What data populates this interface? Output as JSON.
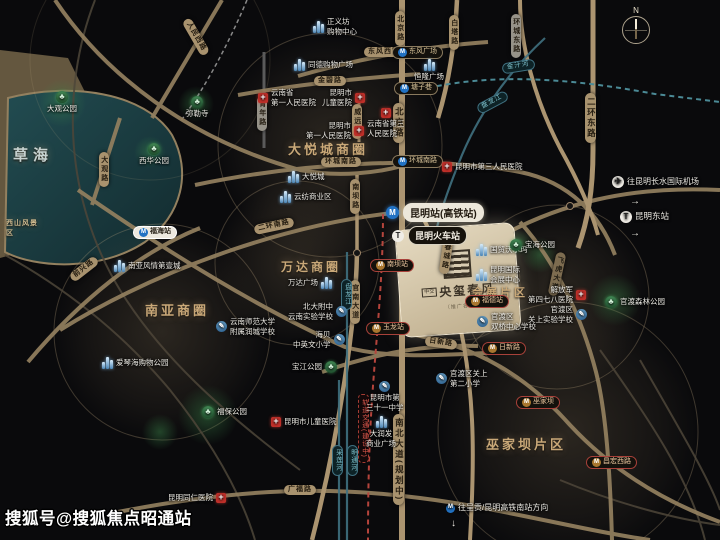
{
  "watermark": "搜狐号@搜狐焦点昭通站",
  "compass": {
    "north": "N"
  },
  "project": {
    "prefix": "中交",
    "name": "央玺春风",
    "note": "（推广名）"
  },
  "districts": {
    "caohai": "草海",
    "xishan": "西山风景区",
    "dayuecheng": "大悦城商圈",
    "wanda": "万达商圈",
    "nanya": "南亚商圈",
    "huizhan": "会展片区",
    "wujiaba": "巫家坝片区"
  },
  "roads": {
    "beijing": "北京路",
    "baita": "白塔路",
    "huancheng_dong": "环城东路",
    "erhuan_dong": "二环东路",
    "dongfeng_xi": "东风西路",
    "jinbi": "金碧路",
    "huancheng_nan": "环城南路",
    "erhuan_nan": "二环南路",
    "renmin_xi": "人民西路",
    "daguan": "大观路",
    "qianxing": "前兴路",
    "qingnian": "青年路",
    "weiyuan": "威远街",
    "nanba": "南坝路",
    "guannan": "官南大道",
    "chuncheng": "春城路",
    "feihu": "飞虎大道",
    "rixin": "日新路",
    "guangfu": "广福路",
    "nanbei_planned": "南北大道(规划中)",
    "metro_constr": "轨道交通(建设中)"
  },
  "rivers": {
    "panlong": "盘龙江",
    "jinzhi": "金汁河",
    "cailian": "采莲河",
    "mingtong": "明通河"
  },
  "stations": {
    "dongfeng_sq": "东风广场",
    "tangzixiang": "塘子巷",
    "huancheng_nan": "环城南路",
    "fuhai": "福海站",
    "nanba": "南坝站",
    "yulong": "玉龙站",
    "fude": "福德站",
    "rixin": "日新路",
    "wujiaba": "巫家坝",
    "changhong": "昌宏西路",
    "kunming_hsr": "昆明站(高铁站)",
    "kunming_rail": "昆明火车站"
  },
  "malls": {
    "zhengyifang": {
      "l1": "正义坊",
      "l2": "购物中心"
    },
    "tongde": "同德购物广场",
    "henglong": "恒隆广场",
    "dayuecheng": "大悦城",
    "yunfang": "云纺商业区",
    "wanda": "万达广场",
    "nanya": "南亚风情第壹城",
    "aiqinhai": "爱琴海购物公园",
    "darunfa": {
      "l1": "大润发",
      "l2": "商业广场"
    },
    "guomao": "国贸沃尔玛",
    "guoji": {
      "l1": "昆明国际",
      "l2": "会展中心"
    }
  },
  "hospitals": {
    "sheng_yi": {
      "l1": "云南省",
      "l2": "第一人民医院"
    },
    "ertong": {
      "l1": "昆明市",
      "l2": "儿童医院"
    },
    "shi_yi": {
      "l1": "昆明市",
      "l2": "第一人民医院"
    },
    "sheng_san": {
      "l1": "云南省第三",
      "l2": "人民医院"
    },
    "shi_san": "昆明市第三人民医院",
    "jiefangjun": {
      "l1": "解放军",
      "l2": "第四七八医院"
    },
    "tongren": "昆明同仁医院",
    "ertong_s": "昆明市儿童医院"
  },
  "schools": {
    "beida": {
      "l1": "北大附中",
      "l2": "云南实验学校"
    },
    "haibei": {
      "l1": "海贝",
      "l2": "中英文小学"
    },
    "shida": {
      "l1": "云南师范大学",
      "l2": "附属润城学校"
    },
    "sanshiyi": {
      "l1": "昆明市第",
      "l2": "三十一中学"
    },
    "guanshang_shiyan": {
      "l1": "官渡区",
      "l2": "关上实验学校"
    },
    "guanshang_erxiao": {
      "l1": "官渡区关上",
      "l2": "第二小学"
    },
    "shuangqiao": {
      "l1": "官渡区",
      "l2": "双桥中心学校"
    }
  },
  "parks": {
    "daguan": "大观公园",
    "milesi": "弥勒寺",
    "xihua": "西华公园",
    "baohai": "宝海公园",
    "guandu_forest": "官渡森林公园",
    "baojiang": "宝江公园",
    "fubao": "福保公园"
  },
  "directions": {
    "airport": "往昆明长水国际机场",
    "dong_station": "昆明东站",
    "chenggong": "往呈贡/昆明高铁南站方向",
    "arrow_right": "→",
    "arrow_down": "↓"
  }
}
